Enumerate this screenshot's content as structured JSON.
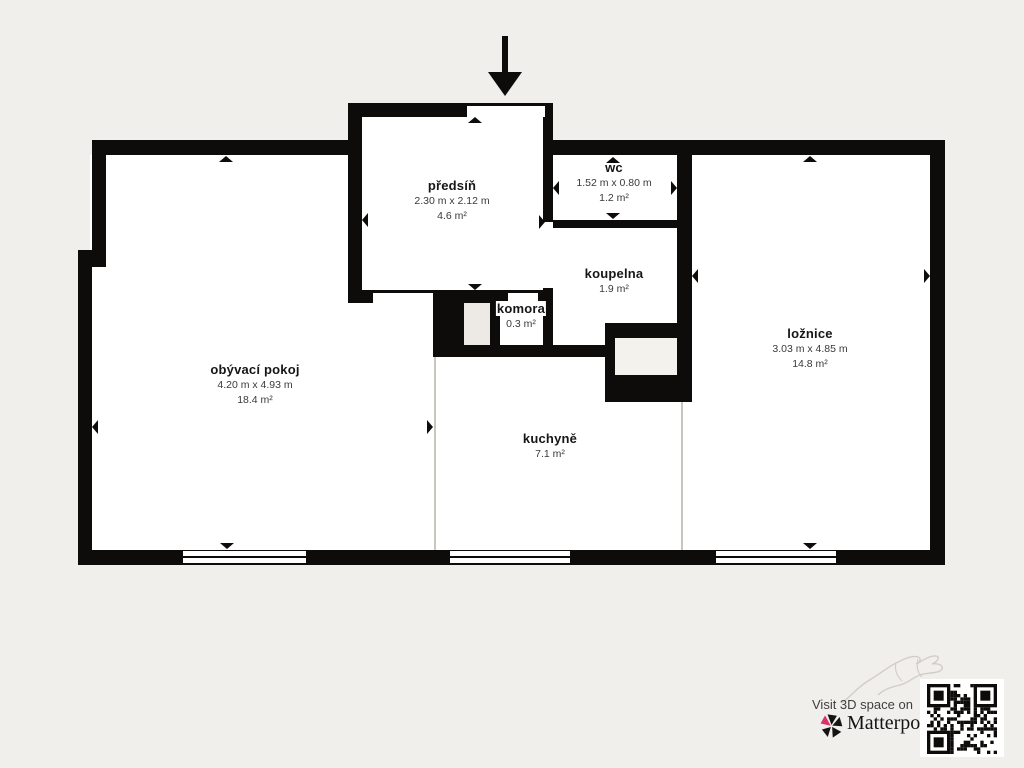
{
  "rooms": [
    {
      "id": "obyvaci-pokoj",
      "name": "obývací pokoj",
      "dims": "4.20 m x 4.93 m",
      "area": "18.4 m²"
    },
    {
      "id": "predsin",
      "name": "předsíň",
      "dims": "2.30 m x 2.12 m",
      "area": "4.6 m²"
    },
    {
      "id": "wc",
      "name": "wc",
      "dims": "1.52 m x 0.80 m",
      "area": "1.2 m²"
    },
    {
      "id": "koupelna",
      "name": "koupelna",
      "area": "1.9 m²"
    },
    {
      "id": "komora",
      "name": "komora",
      "area": "0.3 m²"
    },
    {
      "id": "kuchyne",
      "name": "kuchyně",
      "area": "7.1 m²"
    },
    {
      "id": "loznice",
      "name": "ložnice",
      "dims": "3.03 m x 4.85 m",
      "area": "14.8 m²"
    }
  ],
  "branding": {
    "visit_text": "Visit 3D space on",
    "brand_name": "Matterport",
    "trademark": "™",
    "logo_pink": "#d93468",
    "logo_black": "#151413"
  },
  "colors": {
    "background": "#f1efeb",
    "walls": "#0e0c0b",
    "room_fill": "#ffffff",
    "divider_line": "#c9c6c1"
  }
}
